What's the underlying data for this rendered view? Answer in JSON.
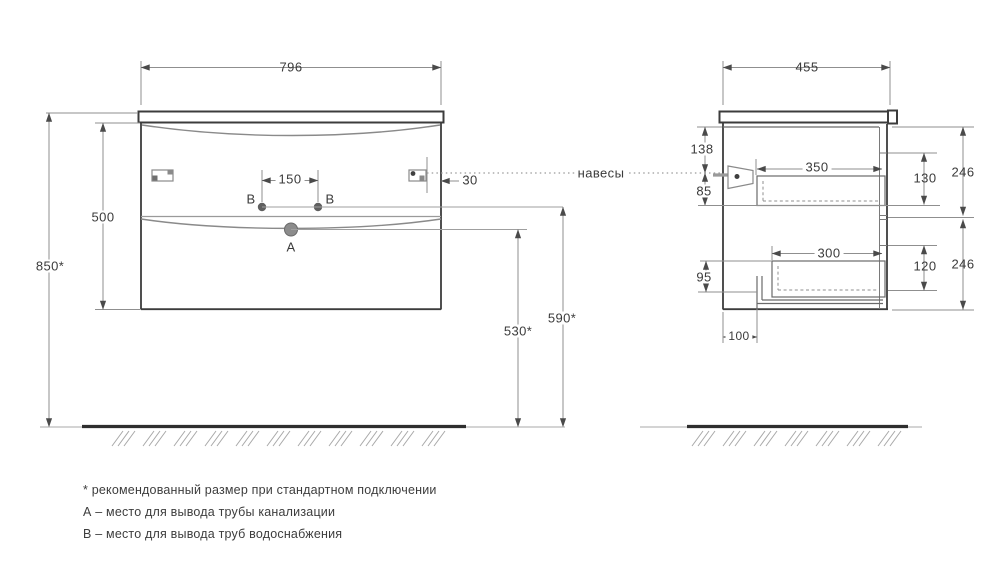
{
  "front_view": {
    "width": "796",
    "carcass_height": "500",
    "mounting_height": "850*",
    "water_points_span": "150",
    "bracket_inset": "30",
    "point_b_left": "B",
    "point_b_right": "B",
    "point_a": "A",
    "drain_height": "530*",
    "water_height": "590*"
  },
  "side_view": {
    "depth": "455",
    "top_to_bracket": "138",
    "bracket_to_drawer": "85",
    "drawer_gap": "95",
    "pipe_offset": "100",
    "upper_drawer_depth": "350",
    "lower_drawer_depth": "300",
    "upper_drawer_height": "130",
    "lower_drawer_height": "120",
    "upper_front_height": "246",
    "lower_front_height": "246"
  },
  "callouts": {
    "hangers": "навесы"
  },
  "footnotes": {
    "recommended_size": "* рекомендованный размер при стандартном подключении",
    "point_a": "А – место для вывода трубы канализации",
    "point_b": "В – место для вывода труб водоснабжения"
  },
  "colors": {
    "line_dark": "#3c3c3c",
    "line_dim": "#8f8f8f",
    "text": "#3b3b3b"
  }
}
